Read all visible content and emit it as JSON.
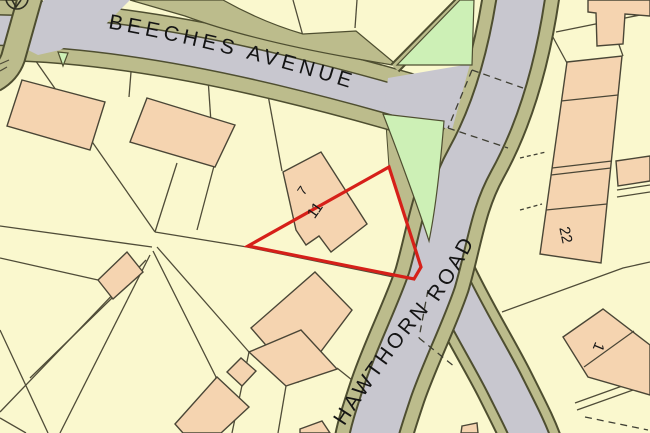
{
  "map": {
    "title": "Location plan",
    "streets": [
      {
        "name": "BEECHES AVENUE"
      },
      {
        "name": "HAWTHORN ROAD"
      }
    ],
    "plots": [
      {
        "number": "7"
      },
      {
        "number": "11",
        "highlighted": true
      },
      {
        "number": "22"
      },
      {
        "number": "1"
      }
    ],
    "boundary": {
      "plot": "11",
      "color": "#d62019",
      "style": "solid-outline"
    },
    "colors": {
      "parcel_fill": "#faf8ce",
      "building_fill": "#f5d4b0",
      "road_fill": "#c8c7cf",
      "verge_fill": "#bcbc8c",
      "green_fill": "#cdf0b6",
      "casing_line": "#4e4e30",
      "parcel_line": "#4f4c38",
      "boundary_red": "#d62019"
    },
    "symbols": [
      {
        "name": "circle-marker",
        "position": "top-left"
      }
    ]
  }
}
